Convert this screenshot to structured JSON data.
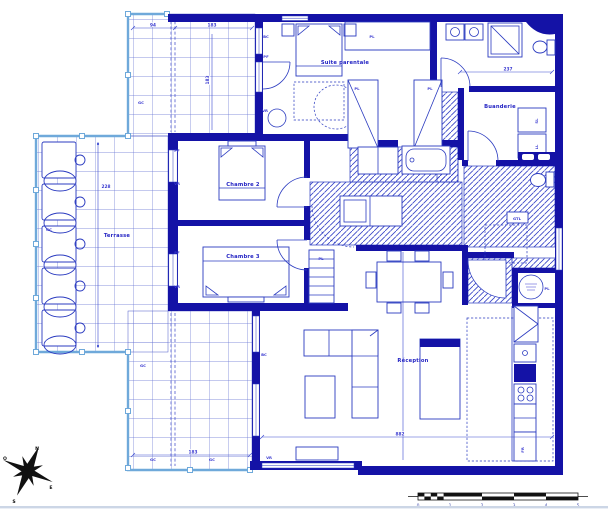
{
  "plan": {
    "rooms": {
      "terrasse": "Terrasse",
      "chambre2": "Chambre 2",
      "chambre3": "Chambre 3",
      "suite": "Suite parentale",
      "buanderie": "Buanderie",
      "reception": "Réception"
    },
    "codes": {
      "gc": "GC",
      "vr": "VR",
      "pf": "PF",
      "pl": "PL",
      "bc": "BC",
      "gtl": "GTL",
      "fr": "FR",
      "sl": "SL",
      "ll": "LL"
    },
    "dims": {
      "d94": "94",
      "d183": "183",
      "d228": "228",
      "d237": "237",
      "d882": "882"
    },
    "compass": {
      "north": "N",
      "south": "S",
      "east": "E",
      "west": "O"
    },
    "scalebar": {
      "t0": "0",
      "t1": "1",
      "t2": "2",
      "t3": "3",
      "t4": "4",
      "t5": "5"
    },
    "colors": {
      "wall": "#1412a6",
      "line": "#2b3bc0",
      "grid": "#6470d2",
      "railing": "#6fa9da",
      "label": "#2323c3",
      "ink": "#111111"
    }
  }
}
